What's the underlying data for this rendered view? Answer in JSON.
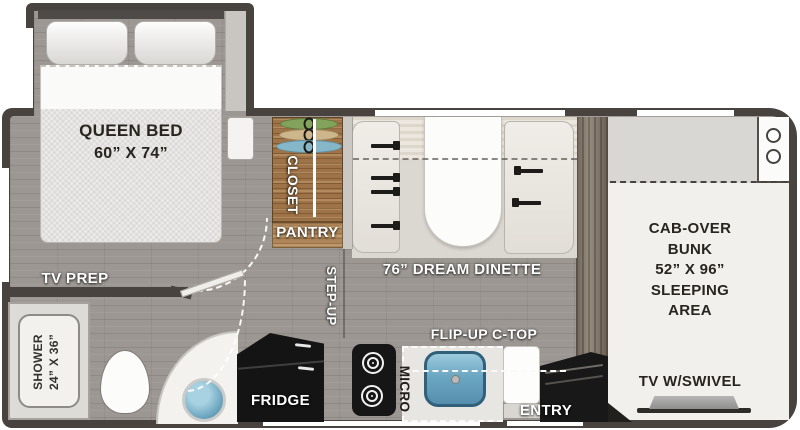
{
  "labels": {
    "queen_bed": [
      "QUEEN BED",
      "60” X 74”"
    ],
    "tv_prep": "TV PREP",
    "shower": [
      "SHOWER",
      "24” X 36”"
    ],
    "closet": "CLOSET",
    "pantry": "PANTRY",
    "step_up": "STEP-UP",
    "dinette": "76” DREAM DINETTE",
    "flip_up_ctop": "FLIP-UP C-TOP",
    "fridge": "FRIDGE",
    "micro": "MICRO",
    "entry": "ENTRY",
    "cab_over_bunk": [
      "CAB-OVER",
      "BUNK",
      "52” X 96”",
      "SLEEPING",
      "AREA"
    ],
    "tv_swivel": "TV W/SWIVEL"
  },
  "colors": {
    "wall": "#48433e",
    "floor": "#9c9792",
    "closet_wood": "#9e7347",
    "cab_wood": "#8b7f71",
    "bench": "#ece9e3",
    "table": "#fcfcfb",
    "sink_blue": "#6ba6c2",
    "appliance_black": "#161616",
    "hanger_green": "#82a35c",
    "hanger_tan": "#cdb68c",
    "hanger_blue": "#85b7c9",
    "bunk_top": "#d8d7d4",
    "bunk_main": "#f1f0ed"
  },
  "icons": {
    "hangers": [
      "hanger-green-icon",
      "hanger-tan-icon",
      "hanger-blue-icon"
    ],
    "seat_belts": "seat-belt-icon",
    "burners": "stove-burner-icon",
    "tv": "tv-icon",
    "cupholders": "cupholder-icon",
    "door_swing": "door-swing-arc"
  }
}
